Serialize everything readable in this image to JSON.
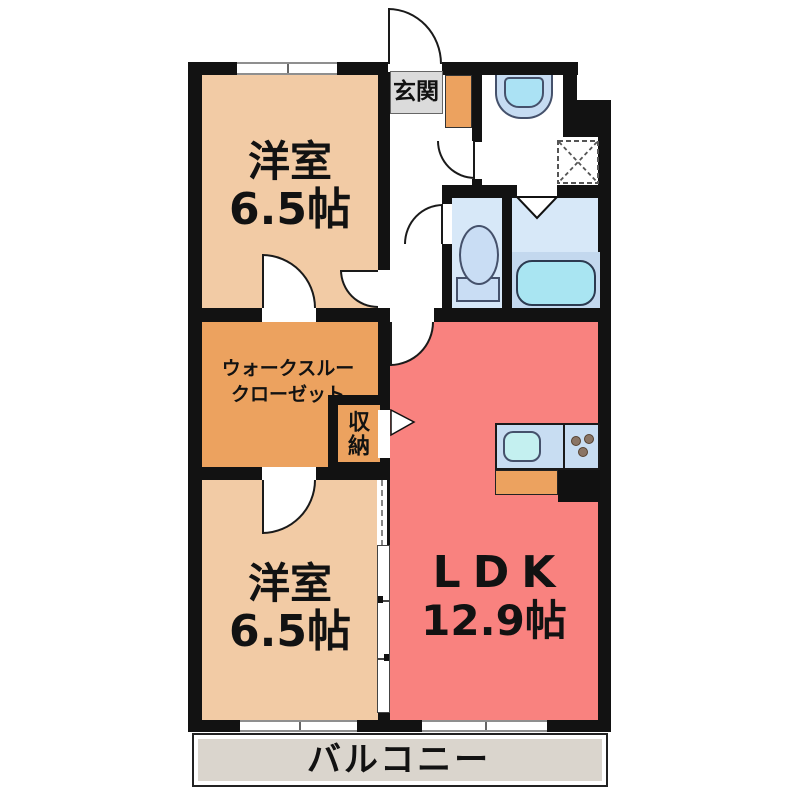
{
  "floorplan": {
    "type": "apartment-floor-plan",
    "rooms": {
      "bedroom_top": {
        "name": "洋室",
        "size": "6.5帖"
      },
      "bedroom_bottom": {
        "name": "洋室",
        "size": "6.5帖"
      },
      "ldk": {
        "name": "LDK",
        "size": "12.9帖"
      },
      "walk_through_closet": {
        "name_line1": "ウォークスルー",
        "name_line2": "クローゼット"
      },
      "storage": {
        "name": "収納"
      },
      "entrance": {
        "name": "玄関"
      },
      "balcony": {
        "name": "バルコニー"
      }
    },
    "fixtures": [
      "entry-door",
      "washbasin",
      "washing-machine-space",
      "toilet",
      "bathtub",
      "kitchen-sink",
      "kitchen-stove",
      "sliding-door",
      "hinged-doors"
    ],
    "colors": {
      "wall": "#121212",
      "bedroom": "#F2CBA5",
      "closet_and_entry_floor": "#ECA25F",
      "ldk": "#F9827F",
      "wet_rooms": "#D7E8F8",
      "fixture_blue": "#C8DDF2",
      "sink_cyan": "#ABE2F4",
      "entrance_label_box": "#DBDBDB",
      "balcony": "#DAD5CD",
      "background": "#FFFFFF"
    }
  }
}
